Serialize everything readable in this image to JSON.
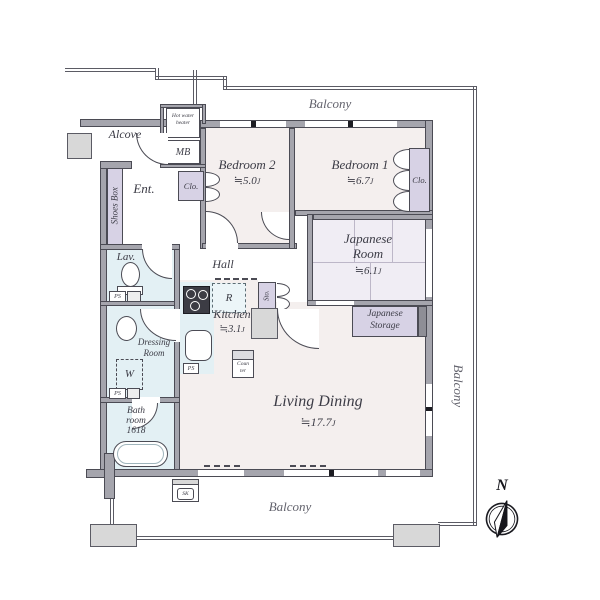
{
  "balconies": {
    "top": "Balcony",
    "bottom": "Balcony",
    "right": "Balcony"
  },
  "compass": {
    "north_label": "N"
  },
  "rooms": {
    "alcove": {
      "name": "Alcove"
    },
    "entrance": {
      "name": "Ent."
    },
    "hall": {
      "name": "Hall"
    },
    "bedroom2": {
      "name": "Bedroom 2",
      "size_value": "≒5.0",
      "size_unit": "J"
    },
    "bedroom1": {
      "name": "Bedroom 1",
      "size_value": "≒6.7",
      "size_unit": "J"
    },
    "japanese_room": {
      "name_line1": "Japanese",
      "name_line2": "Room",
      "size_value": "≒6.1",
      "size_unit": "J"
    },
    "kitchen": {
      "name": "Kitchen",
      "size_value": "≒3.1",
      "size_unit": "J"
    },
    "living_dining": {
      "name": "Living Dining",
      "size_value": "≒17.7",
      "size_unit": "J"
    },
    "lavatory": {
      "name": "Lav."
    },
    "dressing_room": {
      "name_line1": "Dressing",
      "name_line2": "Room"
    },
    "bathroom": {
      "name_line1": "Bath",
      "name_line2": "room",
      "size": "1618"
    }
  },
  "storage": {
    "shoes_box": "Shoes Box",
    "closet_bedroom2": "Clo.",
    "closet_bedroom1": "Clo.",
    "japanese_storage_line1": "Japanese",
    "japanese_storage_line2": "Storage",
    "storage_small": "Sto."
  },
  "fixtures": {
    "meter_box": "MB",
    "hot_water_heater_line1": "Hot water",
    "hot_water_heater_line2": "heater",
    "refrigerator": "R",
    "washer": "W",
    "pipe_space": "PS",
    "slop_sink": "SK",
    "counter_line1": "Coun",
    "counter_line2": "ter"
  },
  "colors": {
    "wall_fill": "#a5a5ad",
    "line": "#4b4b54",
    "outer_line": "#5b5b64",
    "floor": "#f4efee",
    "tatami_floor": "#f0edf4",
    "closet": "#d7d2e5",
    "wet_area": "#e3f0f4",
    "concrete": "#d8d8d8",
    "text": "#3c3c46",
    "balcony_text": "#63636d"
  }
}
